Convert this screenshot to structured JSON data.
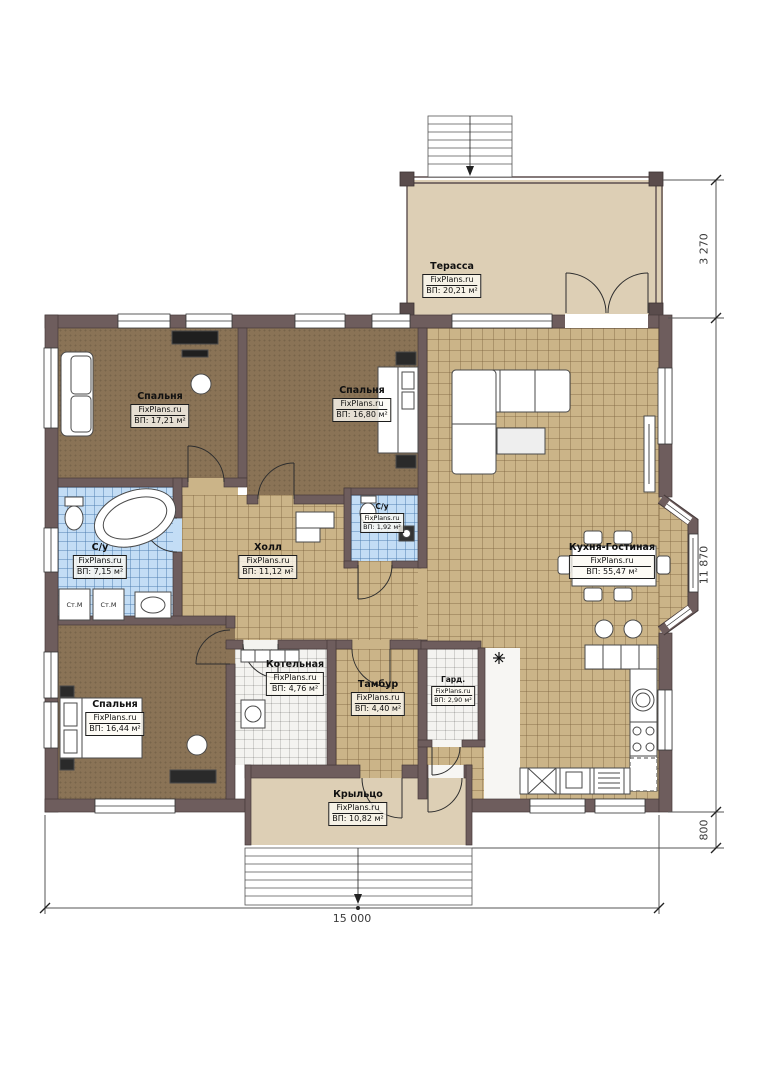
{
  "brand": "FixPlans.ru",
  "rooms": {
    "terrace": {
      "name": "Терасса",
      "brand": "FixPlans.ru",
      "area": "ВП: 20,21 м²"
    },
    "bedroom_top_left": {
      "name": "Спальня",
      "brand": "FixPlans.ru",
      "area": "ВП: 17,21 м²"
    },
    "bedroom_top_middle": {
      "name": "Спальня",
      "brand": "FixPlans.ru",
      "area": "ВП: 16,80 м²"
    },
    "wc_small": {
      "name": "С/у",
      "brand": "FixPlans.ru",
      "area": "ВП: 1,92 м²"
    },
    "bathroom": {
      "name": "С/у",
      "brand": "FixPlans.ru",
      "area": "ВП: 7,15 м²"
    },
    "hall": {
      "name": "Холл",
      "brand": "FixPlans.ru",
      "area": "ВП: 11,12 м²"
    },
    "kitchen_living": {
      "name": "Кухня-Гостиная",
      "brand": "FixPlans.ru",
      "area": "ВП: 55,47 м²"
    },
    "boiler": {
      "name": "Котельная",
      "brand": "FixPlans.ru",
      "area": "ВП: 4,76 м²"
    },
    "tambour": {
      "name": "Тамбур",
      "brand": "FixPlans.ru",
      "area": "ВП: 4,40 м²"
    },
    "wardrobe": {
      "name": "Гард.",
      "brand": "FixPlans.ru",
      "area": "ВП: 2,90 м²"
    },
    "bedroom_bottom_left": {
      "name": "Спальня",
      "brand": "FixPlans.ru",
      "area": "ВП: 16,44 м²"
    },
    "porch": {
      "name": "Крыльцо",
      "brand": "FixPlans.ru",
      "area": "ВП: 10,82 м²"
    }
  },
  "appliances": {
    "washing_machine_1": "Ст.М",
    "washing_machine_2": "Ст.М"
  },
  "dimensions": {
    "terrace_height": "3 270",
    "house_height": "11 870",
    "porch_height": "800",
    "total_width": "15 000"
  },
  "colors": {
    "wall": "#6e5d5d",
    "floor_tan_tile": "#cbb488",
    "floor_brown": "#8a7356",
    "floor_blue_tile": "#c3ddf5",
    "floor_beige": "#ddcfb5"
  }
}
